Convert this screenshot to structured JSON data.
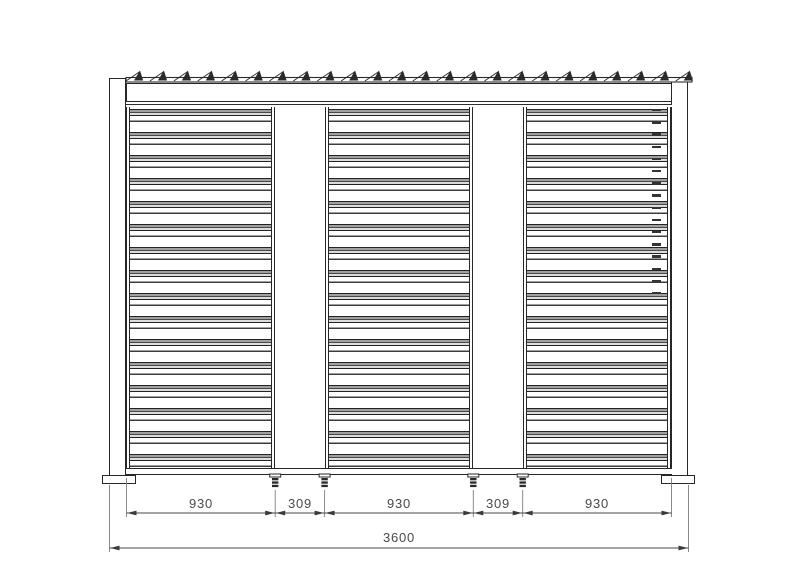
{
  "dimensions": {
    "segments": [
      {
        "label": "930"
      },
      {
        "label": "309"
      },
      {
        "label": "930"
      },
      {
        "label": "309"
      },
      {
        "label": "930"
      }
    ],
    "total": {
      "label": "3600"
    }
  },
  "colors": {
    "line": "#272727",
    "louver_gray": "#a0a0a0",
    "dimension_text": "#4a4a4a",
    "background": "#ffffff"
  }
}
